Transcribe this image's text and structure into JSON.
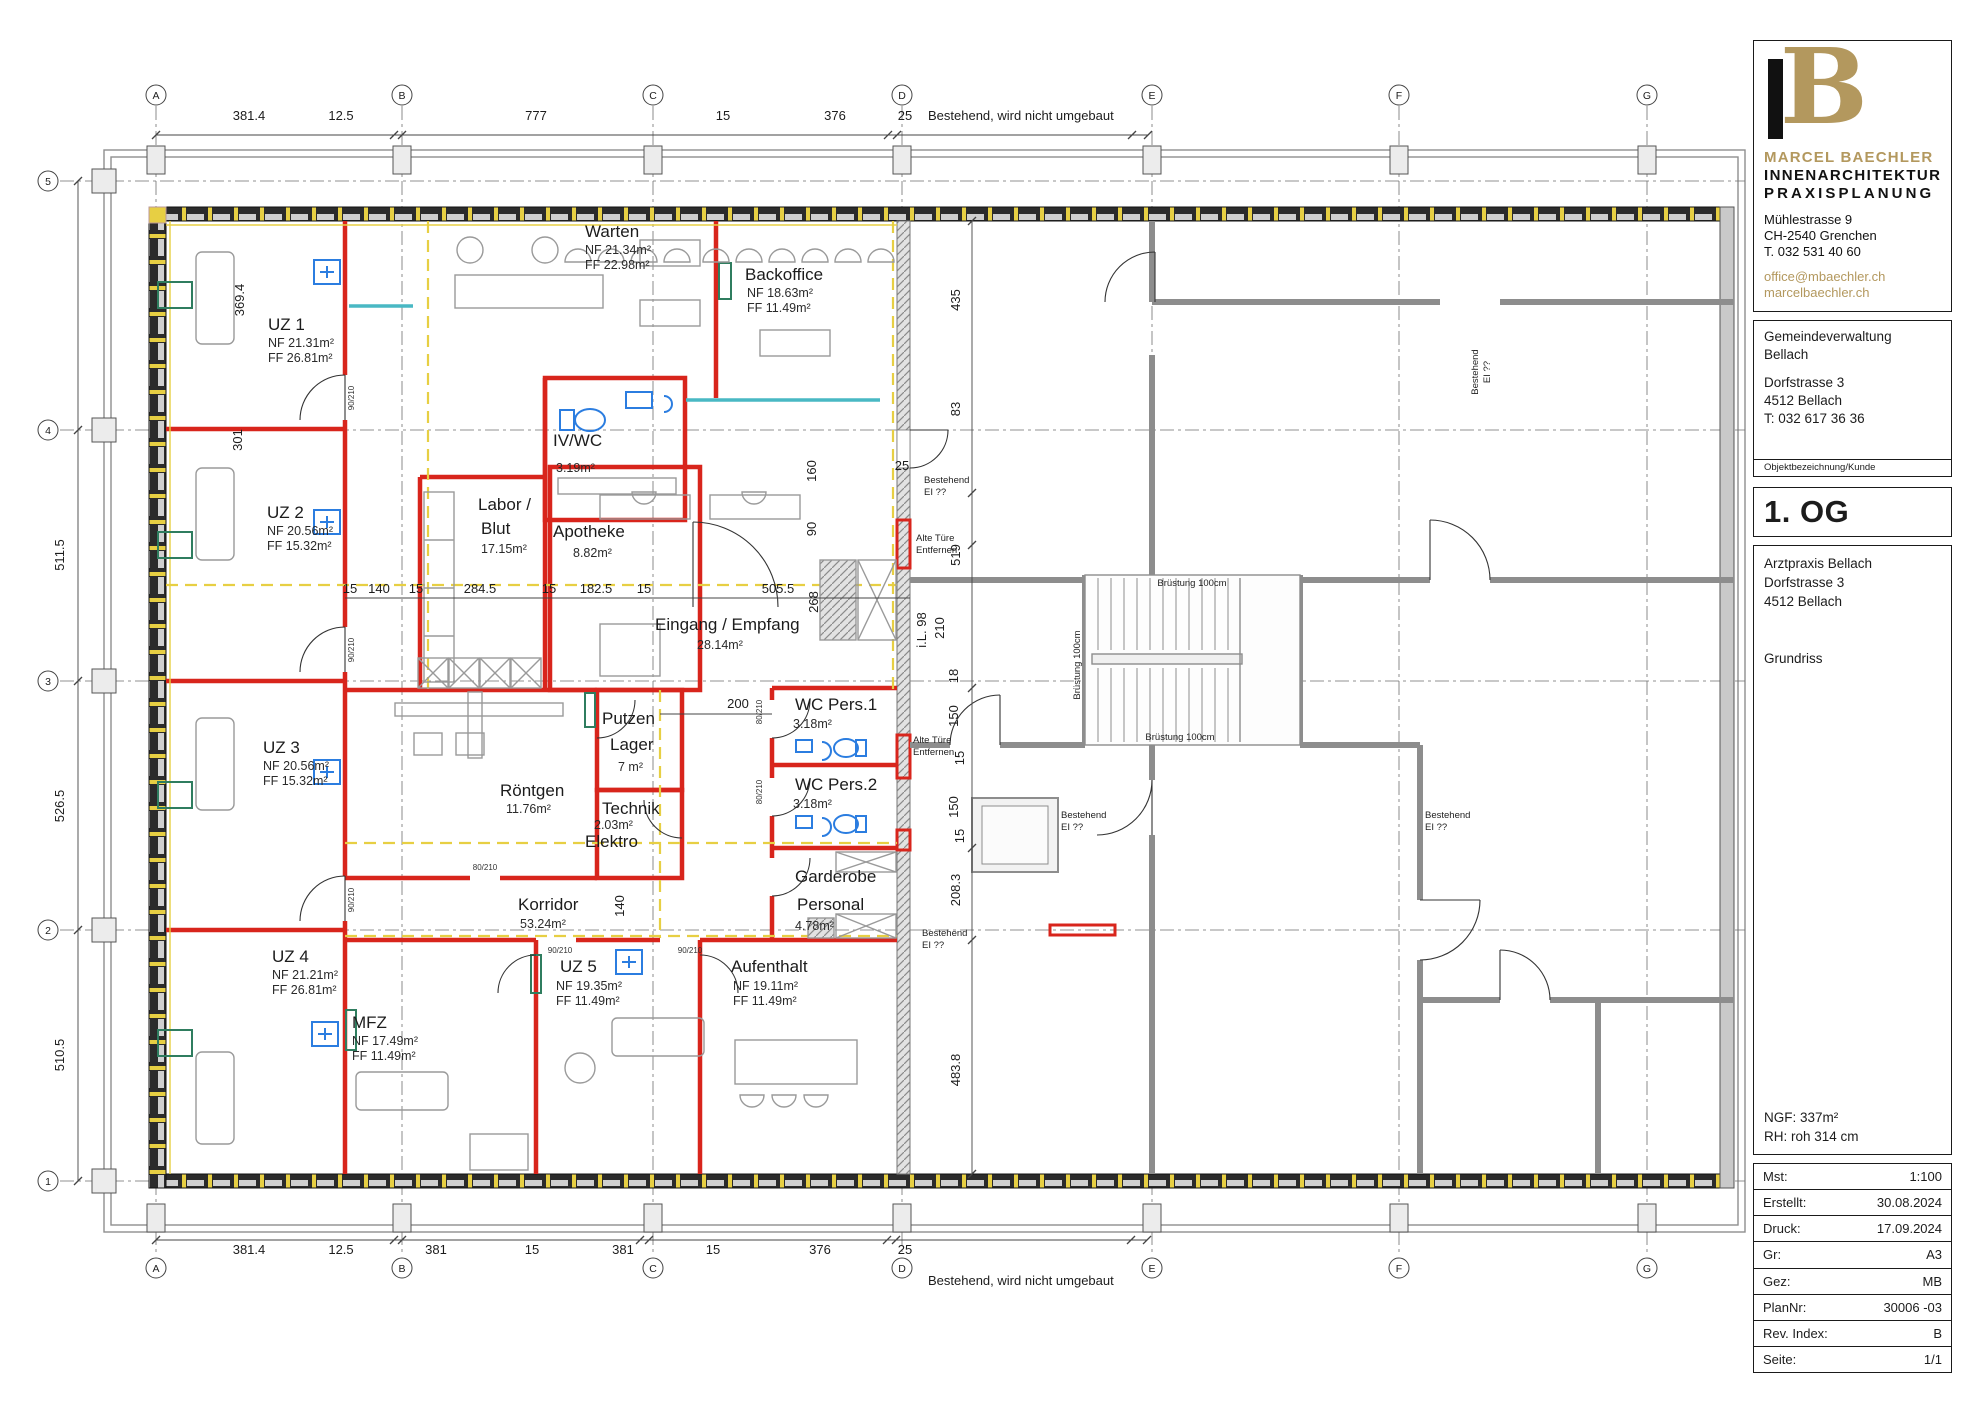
{
  "titleblock": {
    "logo": {
      "monogram": "B",
      "name": "MARCEL BAECHLER",
      "line2": "INNENARCHITEKTUR",
      "line3": "PRAXISPLANUNG",
      "address1": "Mühlestrasse 9",
      "address2": "CH-2540 Grenchen",
      "phone": "T. 032 531 40 60",
      "email": "office@mbaechler.ch",
      "website": "marcelbaechler.ch"
    },
    "client": {
      "line1": "Gemeindeverwaltung",
      "line2": "Bellach",
      "line3": "Dorfstrasse 3",
      "line4": "4512 Bellach",
      "line5": "T: 032 617 36 36",
      "caption": "Objektbezeichnung/Kunde"
    },
    "floor_title": "1. OG",
    "project": {
      "line1": "Arztpraxis Bellach",
      "line2": "Dorfstrasse 3",
      "line3": "4512 Bellach",
      "drawing_type": "Grundriss",
      "ngf": "NGF: 337m²",
      "rh": "RH: roh 314 cm"
    },
    "table": {
      "rows": [
        {
          "label": "Mst:",
          "value": "1:100"
        },
        {
          "label": "Erstellt:",
          "value": "30.08.2024"
        },
        {
          "label": "Druck:",
          "value": "17.09.2024"
        },
        {
          "label": "Gr:",
          "value": "A3"
        },
        {
          "label": "Gez:",
          "value": "MB"
        },
        {
          "label": "PlanNr:",
          "value": "30006 -03"
        },
        {
          "label": "Rev. Index:",
          "value": "B"
        },
        {
          "label": "Seite:",
          "value": "1/1"
        }
      ]
    }
  },
  "plan": {
    "annotations": {
      "existing_top": "Bestehend, wird nicht umgebaut",
      "existing_bottom": "Bestehend, wird nicht umgebaut",
      "old_door_1": "Alte Türe",
      "old_door_2": "Entfernen",
      "existing_door_1": "Bestehend",
      "existing_door_2": "EI ??",
      "parapet": "Brüstung 100cm"
    },
    "grid": {
      "letters": [
        "A",
        "B",
        "C",
        "D",
        "E",
        "F",
        "G"
      ],
      "numbers": [
        "5",
        "4",
        "3",
        "2",
        "1"
      ]
    },
    "rooms": [
      {
        "name": "UZ 1",
        "l2": "NF 21.31m²",
        "l3": "FF 26.81m²"
      },
      {
        "name": "UZ 2",
        "l2": "NF 20.56m²",
        "l3": "FF 15.32m²"
      },
      {
        "name": "UZ 3",
        "l2": "NF 20.56m²",
        "l3": "FF 15.32m²"
      },
      {
        "name": "UZ 4",
        "l2": "NF 21.21m²",
        "l3": "FF 26.81m²"
      },
      {
        "name": "Warten",
        "l2": "NF 21.34m²",
        "l3": "FF 22.98m²"
      },
      {
        "name": "Backoffice",
        "l2": "NF 18.63m²",
        "l3": "FF 11.49m²"
      },
      {
        "name": "IV/WC",
        "l2": "3.19m²"
      },
      {
        "name": "Labor /",
        "l2": "Blut",
        "l3": "17.15m²"
      },
      {
        "name": "Apotheke",
        "l2": "8.82m²"
      },
      {
        "name": "Eingang / Empfang",
        "l2": "28.14m²"
      },
      {
        "name": "Putzen",
        "l2": "Lager",
        "l3": "7 m²"
      },
      {
        "name": "WC Pers.1",
        "l2": "3.18m²"
      },
      {
        "name": "WC Pers.2",
        "l2": "3.18m²"
      },
      {
        "name": "Röntgen",
        "l2": "11.76m²"
      },
      {
        "name": "Technik",
        "l2": "2.03m²",
        "l3": "Elektro"
      },
      {
        "name": "Garderobe",
        "l2": "Personal",
        "l3": "4.78m²"
      },
      {
        "name": "Korridor",
        "l2": "53.24m²"
      },
      {
        "name": "UZ 5",
        "l2": "NF 19.35m²",
        "l3": "FF 11.49m²"
      },
      {
        "name": "Aufenthalt",
        "l2": "NF 19.11m²",
        "l3": "FF 11.49m²"
      },
      {
        "name": "MFZ",
        "l2": "NF 17.49m²",
        "l3": "FF 11.49m²"
      }
    ],
    "dims": {
      "top": [
        "381.4",
        "12.5",
        "777",
        "15",
        "376",
        "25"
      ],
      "bottom": [
        "381.4",
        "12.5",
        "381",
        "15",
        "381",
        "15",
        "376",
        "25"
      ],
      "left": [
        "511.5",
        "526.5",
        "510.5"
      ],
      "left_inner": [
        "369.4",
        "301"
      ],
      "mid": [
        "15",
        "140",
        "15",
        "284.5",
        "15",
        "182.5",
        "15",
        "505.5",
        "268",
        "200",
        "140"
      ],
      "right_outer": [
        "435",
        "83",
        "519",
        "208.3",
        "483.8"
      ],
      "right_inner": [
        "25",
        "160",
        "90",
        "i.L. 98",
        "210",
        "18",
        "150",
        "15",
        "150",
        "15"
      ],
      "door_tags": [
        "90/210",
        "80/210"
      ]
    },
    "colors": {
      "new_wall_red": "#d8251c",
      "marker_yellow": "#e7cf43",
      "glass_cyan": "#49b8c4",
      "door_green": "#2f7d5f",
      "fixture_blue": "#2b7de0",
      "brand_gold": "#b3985e"
    }
  }
}
